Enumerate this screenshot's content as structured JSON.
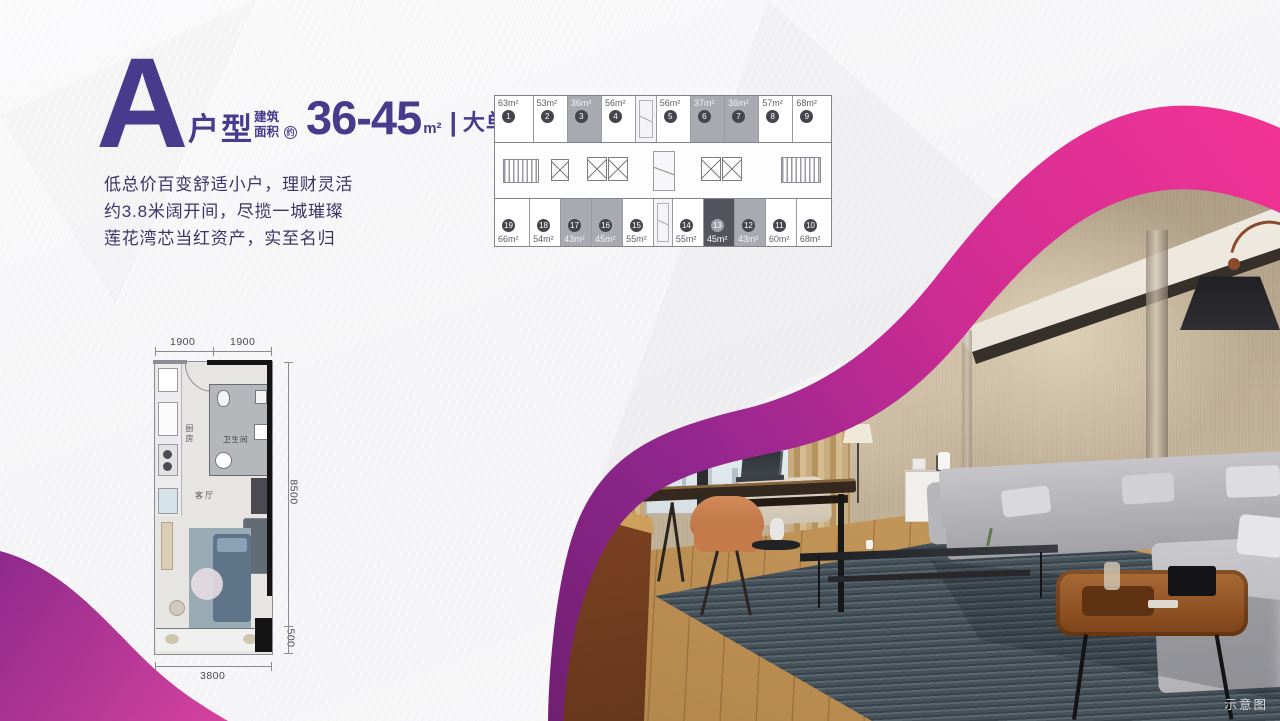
{
  "header": {
    "letter": "A",
    "type_label": "户型",
    "area_label_line1": "建筑",
    "area_label_line2": "面积",
    "area_approx_badge": "约",
    "area_value": "36-45",
    "area_unit": "m²",
    "divider": "|",
    "area_tag": "大单间"
  },
  "description": {
    "line1": "低总价百变舒适小户，理财灵活",
    "line2": "约3.8米阔开间，尽揽一城璀璨",
    "line3": "莲花湾芯当红资产，实至名归"
  },
  "floor_plate": {
    "top_row": [
      {
        "no": "1",
        "area": "63m²",
        "state": "normal"
      },
      {
        "no": "2",
        "area": "53m²",
        "state": "normal"
      },
      {
        "no": "3",
        "area": "36m²",
        "state": "gray"
      },
      {
        "no": "4",
        "area": "56m²",
        "state": "normal"
      },
      {
        "no": "",
        "area": "",
        "state": "shaft"
      },
      {
        "no": "5",
        "area": "56m²",
        "state": "normal"
      },
      {
        "no": "6",
        "area": "37m²",
        "state": "gray"
      },
      {
        "no": "7",
        "area": "36m²",
        "state": "gray"
      },
      {
        "no": "8",
        "area": "57m²",
        "state": "normal"
      },
      {
        "no": "9",
        "area": "68m²",
        "state": "normal"
      }
    ],
    "bottom_row": [
      {
        "no": "19",
        "area": "66m²",
        "state": "normal"
      },
      {
        "no": "18",
        "area": "54m²",
        "state": "normal"
      },
      {
        "no": "17",
        "area": "43m²",
        "state": "gray"
      },
      {
        "no": "16",
        "area": "45m²",
        "state": "gray"
      },
      {
        "no": "15",
        "area": "55m²",
        "state": "normal"
      },
      {
        "no": "",
        "area": "",
        "state": "shaft"
      },
      {
        "no": "14",
        "area": "55m²",
        "state": "normal"
      },
      {
        "no": "13",
        "area": "45m²",
        "state": "dark"
      },
      {
        "no": "12",
        "area": "43m²",
        "state": "gray"
      },
      {
        "no": "11",
        "area": "60m²",
        "state": "normal"
      },
      {
        "no": "10",
        "area": "68m²",
        "state": "normal"
      }
    ]
  },
  "floor_plan": {
    "dim_top_left": "1900",
    "dim_top_right": "1900",
    "dim_right": "8500",
    "dim_right_bottom": "500",
    "dim_bottom": "3800",
    "room_kitchen": "厨房",
    "room_bath": "卫生间",
    "room_living": "客厅"
  },
  "photo": {
    "watermark": "示意图"
  },
  "colors": {
    "purple": "#483a8c",
    "pink": "#ee2f92",
    "magenta_deep": "#93278f"
  }
}
